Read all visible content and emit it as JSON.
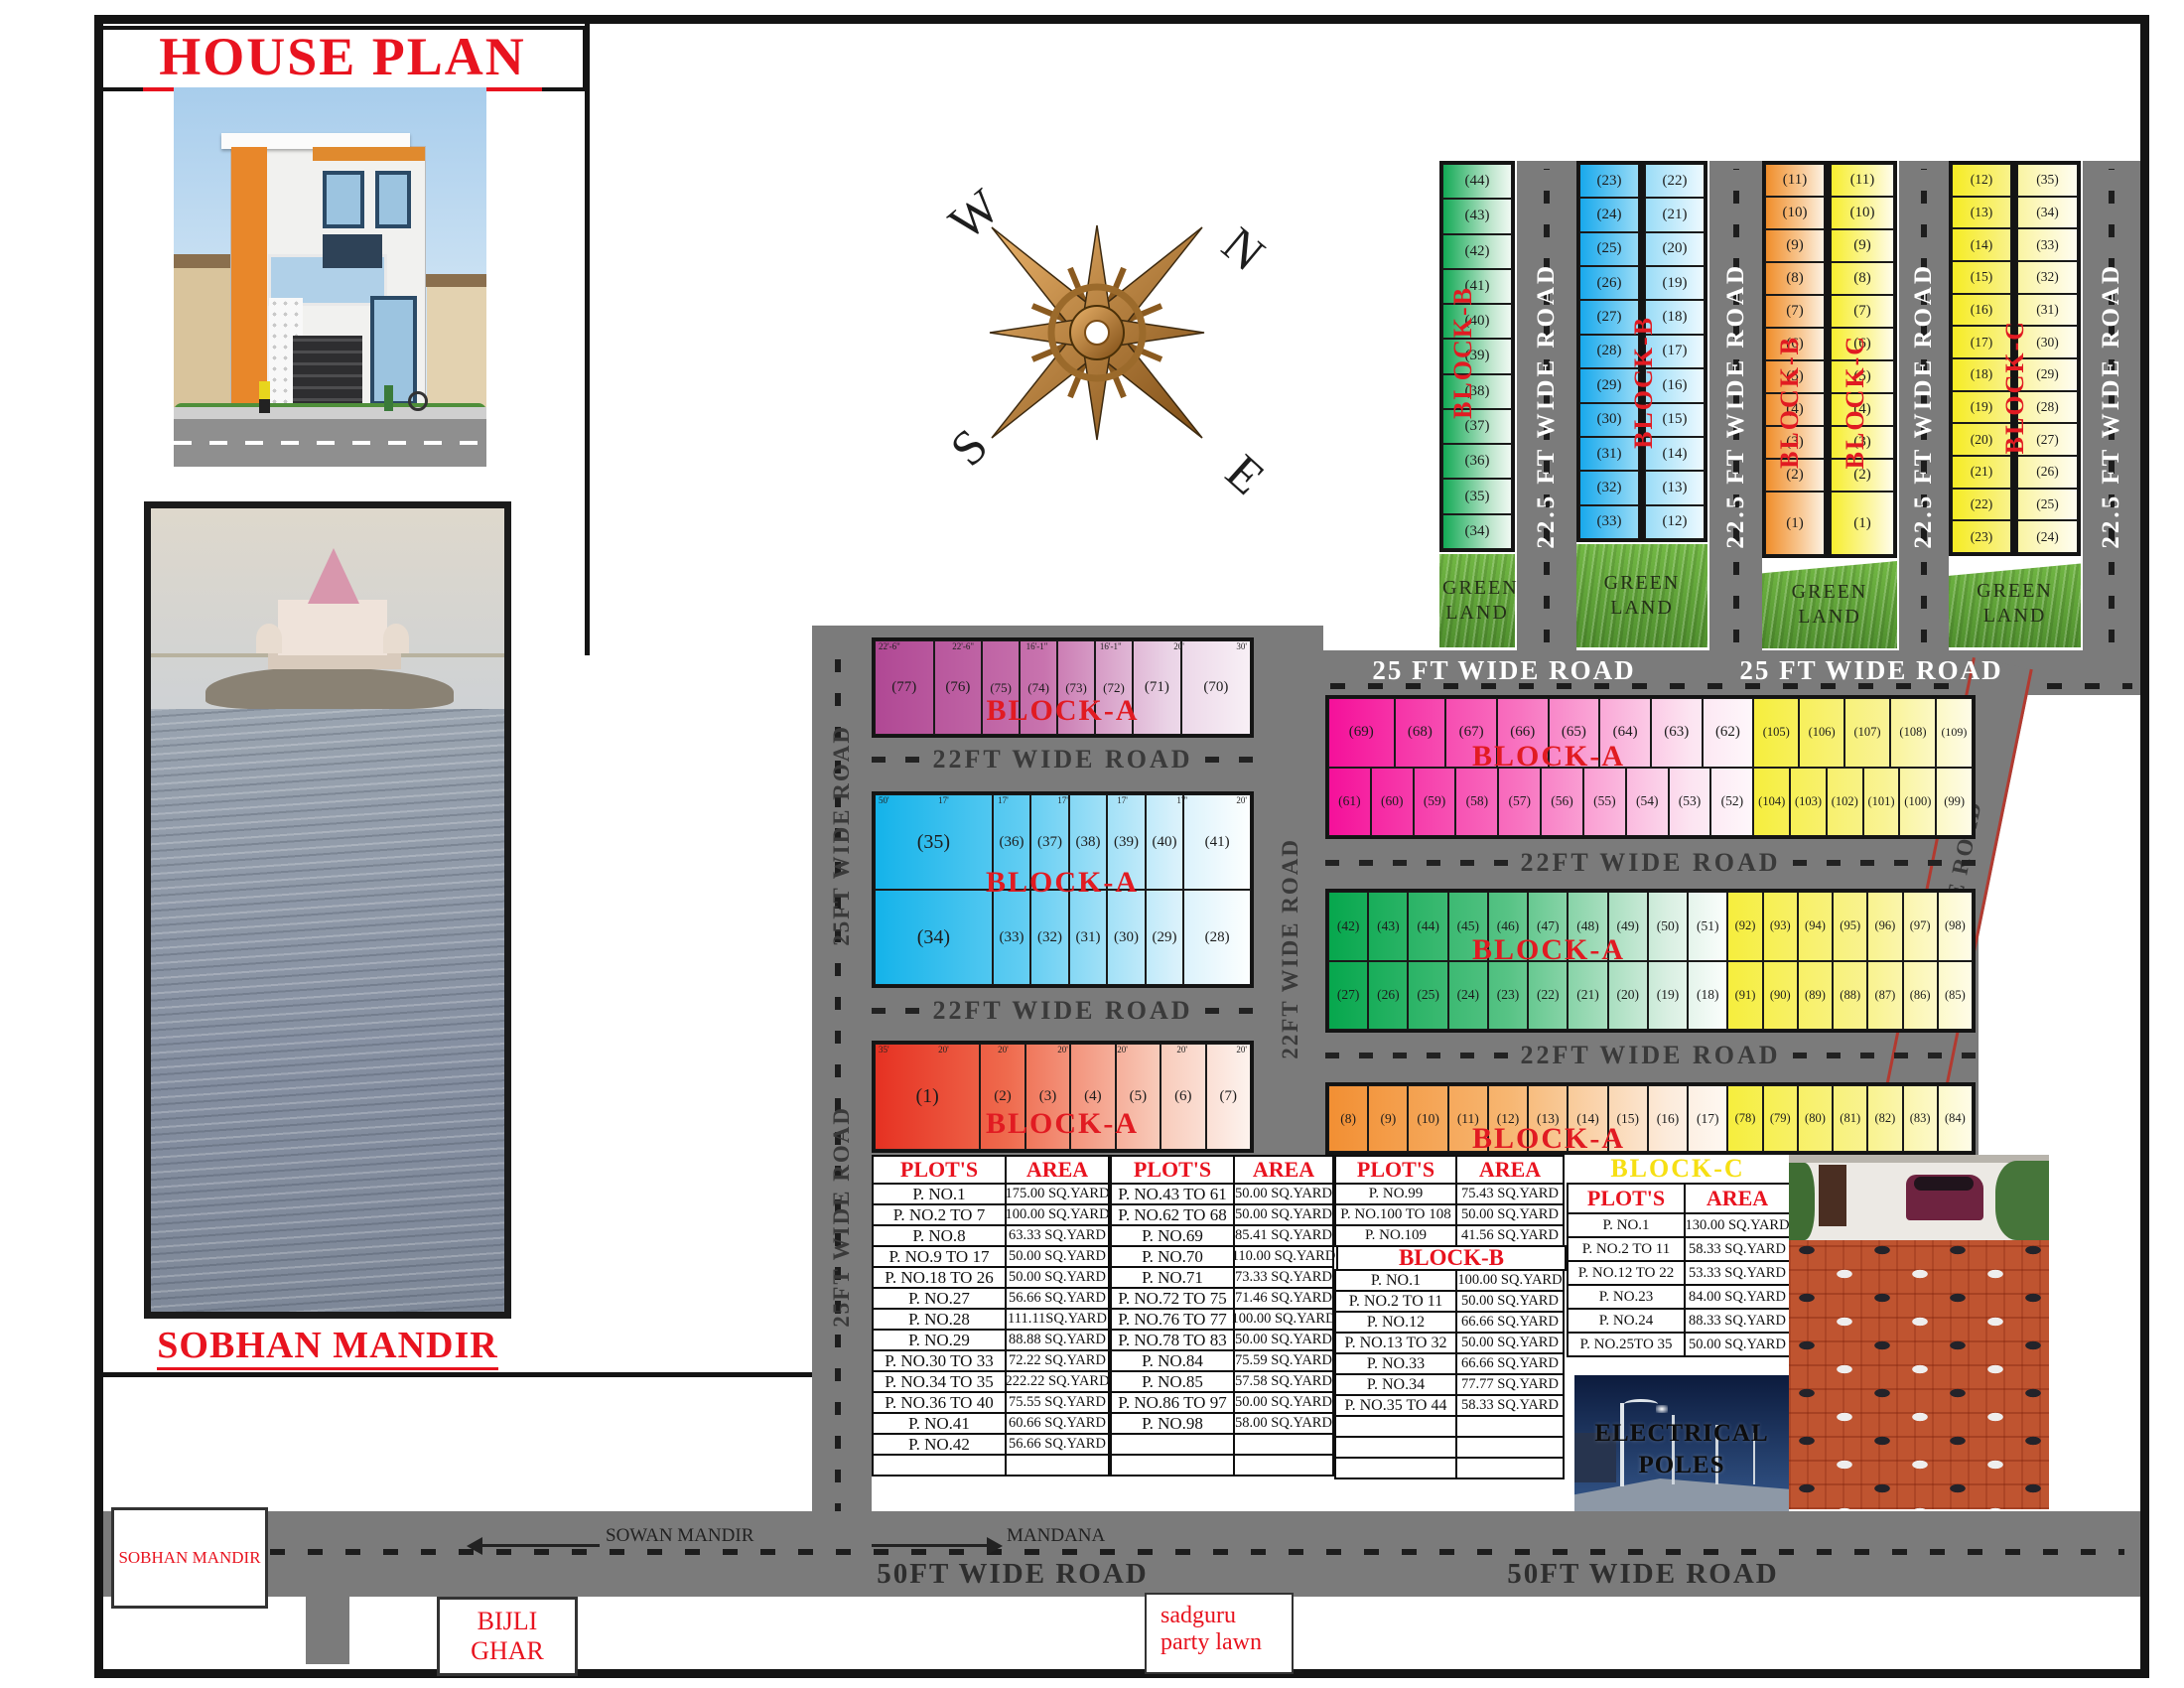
{
  "title": "HOUSE PLAN",
  "captions": {
    "temple": "SOBHAN MANDIR",
    "temple_box": "SOBHAN MANDIR",
    "electrical": "ELECTRICAL POLES"
  },
  "compass": {
    "n": "N",
    "w": "W",
    "s": "S",
    "e": "E"
  },
  "green_land": "GREEN LAND",
  "roads": {
    "w225": "22.5 FT WIDE ROAD",
    "w25top": "25 FT WIDE ROAD",
    "w25left": "25FT WIDE ROAD",
    "w22h": "22FT WIDE ROAD",
    "w15": "15FT WIDE ROAD",
    "w50": "50FT WIDE ROAD"
  },
  "top_right": {
    "green_b": {
      "label": "BLOCK-B",
      "plots": [
        "(44)",
        "(43)",
        "(42)",
        "(41)",
        "(40)",
        "(39)",
        "(38)",
        "(37)",
        "(36)",
        "(35)",
        "(34)"
      ]
    },
    "blue_b": {
      "label": "BLOCK-B",
      "left": [
        "(23)",
        "(24)",
        "(25)",
        "(26)",
        "(27)",
        "(28)",
        "(29)",
        "(30)",
        "(31)",
        "(32)",
        "(33)"
      ],
      "right": [
        "(22)",
        "(21)",
        "(20)",
        "(19)",
        "(18)",
        "(17)",
        "(16)",
        "(15)",
        "(14)",
        "(13)",
        "(12)"
      ]
    },
    "orange_b": {
      "label": "BLOCK-B",
      "plots": [
        "(11)",
        "(10)",
        "(9)",
        "(8)",
        "(7)",
        "(6)",
        "(5)",
        "(4)",
        "(3)",
        "(2)",
        "(1)"
      ]
    },
    "yellow_c": {
      "label": "BLOCK-C",
      "plots": [
        "(11)",
        "(10)",
        "(9)",
        "(8)",
        "(7)",
        "(6)",
        "(5)",
        "(4)",
        "(3)",
        "(2)",
        "(1)"
      ]
    },
    "yellow_pair": {
      "label": "BLOCK-C",
      "left": [
        "(12)",
        "(13)",
        "(14)",
        "(15)",
        "(16)",
        "(17)",
        "(18)",
        "(19)",
        "(20)",
        "(21)",
        "(22)",
        "(23)"
      ],
      "right": [
        "(35)",
        "(34)",
        "(33)",
        "(32)",
        "(31)",
        "(30)",
        "(29)",
        "(28)",
        "(27)",
        "(26)",
        "(25)",
        "(24)"
      ]
    }
  },
  "mid_left": {
    "purple": {
      "label": "BLOCK-A",
      "plots": [
        "(77)",
        "(76)",
        "(75)",
        "(74)",
        "(73)",
        "(72)",
        "(71)",
        "(70)"
      ]
    },
    "cyan": {
      "label": "BLOCK-A",
      "top": [
        "(35)",
        "(36)",
        "(37)",
        "(38)",
        "(39)",
        "(40)",
        "(41)"
      ],
      "bottom": [
        "(34)",
        "(33)",
        "(32)",
        "(31)",
        "(30)",
        "(29)",
        "(28)"
      ]
    },
    "red": {
      "label": "BLOCK-A",
      "plots": [
        "(1)",
        "(2)",
        "(3)",
        "(4)",
        "(5)",
        "(6)",
        "(7)"
      ]
    }
  },
  "mid_right": {
    "pink": {
      "label": "BLOCK-A",
      "top_main": [
        "(69)",
        "(68)",
        "(67)",
        "(66)",
        "(65)",
        "(64)",
        "(63)",
        "(62)"
      ],
      "top_yellow": [
        "(105)",
        "(106)",
        "(107)",
        "(108)",
        "(109)"
      ],
      "bottom_main": [
        "(61)",
        "(60)",
        "(59)",
        "(58)",
        "(57)",
        "(56)",
        "(55)",
        "(54)",
        "(53)",
        "(52)"
      ],
      "bottom_yellow": [
        "(104)",
        "(103)",
        "(102)",
        "(101)",
        "(100)",
        "(99)"
      ]
    },
    "green": {
      "label": "BLOCK-A",
      "top_main": [
        "(42)",
        "(43)",
        "(44)",
        "(45)",
        "(46)",
        "(47)",
        "(48)",
        "(49)",
        "(50)",
        "(51)"
      ],
      "top_yellow": [
        "(92)",
        "(93)",
        "(94)",
        "(95)",
        "(96)",
        "(97)",
        "(98)"
      ],
      "bottom_main": [
        "(27)",
        "(26)",
        "(25)",
        "(24)",
        "(23)",
        "(22)",
        "(21)",
        "(20)",
        "(19)",
        "(18)"
      ],
      "bottom_yellow": [
        "(91)",
        "(90)",
        "(89)",
        "(88)",
        "(87)",
        "(86)",
        "(85)"
      ]
    },
    "orange": {
      "label": "BLOCK-A",
      "main": [
        "(8)",
        "(9)",
        "(10)",
        "(11)",
        "(12)",
        "(13)",
        "(14)",
        "(15)",
        "(16)",
        "(17)"
      ],
      "yellow": [
        "(78)",
        "(79)",
        "(80)",
        "(81)",
        "(82)",
        "(83)",
        "(84)"
      ]
    },
    "block_c_tag": "BLOCK-C"
  },
  "dims": {
    "purple_top": [
      "22'-6\"",
      "22'-6\"",
      "16'-1\"",
      "16'-1\"",
      "20'",
      "30'"
    ],
    "cyan_top": [
      "50'",
      "17'",
      "17'",
      "17'",
      "17'",
      "17'",
      "20'"
    ],
    "cyan_bottom": [
      "50'",
      "16'-3\"",
      "16'-3\"",
      "16'-3\"",
      "16'-3\"",
      "20'",
      "20'"
    ],
    "red_top": [
      "35'",
      "20'",
      "20'",
      "20'",
      "20'",
      "20'",
      "20'"
    ],
    "pink_cell_widths": [
      "18'",
      "15'"
    ],
    "green_cell_width": "15'",
    "orange_cell_width": "15'",
    "column_cell_width": "15'",
    "column_depths": [
      "25'",
      "30'",
      "32'",
      "35'"
    ]
  },
  "tables": {
    "col_plots": "PLOT'S",
    "col_area": "AREA",
    "t1": [
      [
        "P. NO.1",
        "175.00 SQ.YARD"
      ],
      [
        "P. NO.2 TO 7",
        "100.00 SQ.YARD"
      ],
      [
        "P. NO.8",
        "63.33 SQ.YARD"
      ],
      [
        "P. NO.9 TO 17",
        "50.00 SQ.YARD"
      ],
      [
        "P. NO.18 TO 26",
        "50.00 SQ.YARD"
      ],
      [
        "P. NO.27",
        "56.66 SQ.YARD"
      ],
      [
        "P. NO.28",
        "111.11SQ.YARD"
      ],
      [
        "P. NO.29",
        "88.88 SQ.YARD"
      ],
      [
        "P. NO.30 TO 33",
        "72.22 SQ.YARD"
      ],
      [
        "P. NO.34 TO 35",
        "222.22 SQ.YARD"
      ],
      [
        "P. NO.36 TO 40",
        "75.55 SQ.YARD"
      ],
      [
        "P. NO.41",
        "60.66 SQ.YARD"
      ],
      [
        "P. NO.42",
        "56.66 SQ.YARD"
      ],
      [
        "",
        ""
      ]
    ],
    "t2": [
      [
        "P. NO.43 TO 61",
        "50.00 SQ.YARD"
      ],
      [
        "P. NO.62 TO 68",
        "50.00 SQ.YARD"
      ],
      [
        "P. NO.69",
        "85.41 SQ.YARD"
      ],
      [
        "P. NO.70",
        "110.00 SQ.YARD"
      ],
      [
        "P. NO.71",
        "73.33 SQ.YARD"
      ],
      [
        "P. NO.72 TO 75",
        "71.46 SQ.YARD"
      ],
      [
        "P. NO.76 TO 77",
        "100.00 SQ.YARD"
      ],
      [
        "P. NO.78 TO 83",
        "50.00 SQ.YARD"
      ],
      [
        "P. NO.84",
        "75.59 SQ.YARD"
      ],
      [
        "P. NO.85",
        "57.58 SQ.YARD"
      ],
      [
        "P. NO.86 TO 97",
        "50.00 SQ.YARD"
      ],
      [
        "P. NO.98",
        "58.00 SQ.YARD"
      ],
      [
        "",
        ""
      ],
      [
        "",
        ""
      ]
    ],
    "t3_top": [
      [
        "P. NO.99",
        "75.43 SQ.YARD"
      ],
      [
        "P. NO.100 TO 108",
        "50.00 SQ.YARD"
      ],
      [
        "P. NO.109",
        "41.56 SQ.YARD"
      ]
    ],
    "block_b": "BLOCK-B",
    "t3_bottom": [
      [
        "P. NO.1",
        "100.00 SQ.YARD"
      ],
      [
        "P. NO.2 TO 11",
        "50.00 SQ.YARD"
      ],
      [
        "P. NO.12",
        "66.66 SQ.YARD"
      ],
      [
        "P. NO.13 TO 32",
        "50.00 SQ.YARD"
      ],
      [
        "P. NO.33",
        "66.66 SQ.YARD"
      ],
      [
        "P. NO.34",
        "77.77 SQ.YARD"
      ],
      [
        "P. NO.35 TO 44",
        "58.33 SQ.YARD"
      ],
      [
        "",
        ""
      ],
      [
        "",
        ""
      ],
      [
        "",
        ""
      ]
    ],
    "block_c": "BLOCK-C",
    "tc": [
      [
        "P. NO.1",
        "130.00 SQ.YARD"
      ],
      [
        "P. NO.2 TO 11",
        "58.33 SQ.YARD"
      ],
      [
        "P. NO.12 TO 22",
        "53.33 SQ.YARD"
      ],
      [
        "P. NO.23",
        "84.00 SQ.YARD"
      ],
      [
        "P. NO.24",
        "88.33 SQ.YARD"
      ],
      [
        "P. NO.25TO 35",
        "50.00 SQ.YARD"
      ]
    ]
  },
  "bottom": {
    "sowan": "SOWAN MANDIR",
    "mandana": "MANDANA",
    "bijli": "BIJLI GHAR",
    "sadguru_line1": "sadguru",
    "sadguru_line2": "party lawn"
  }
}
